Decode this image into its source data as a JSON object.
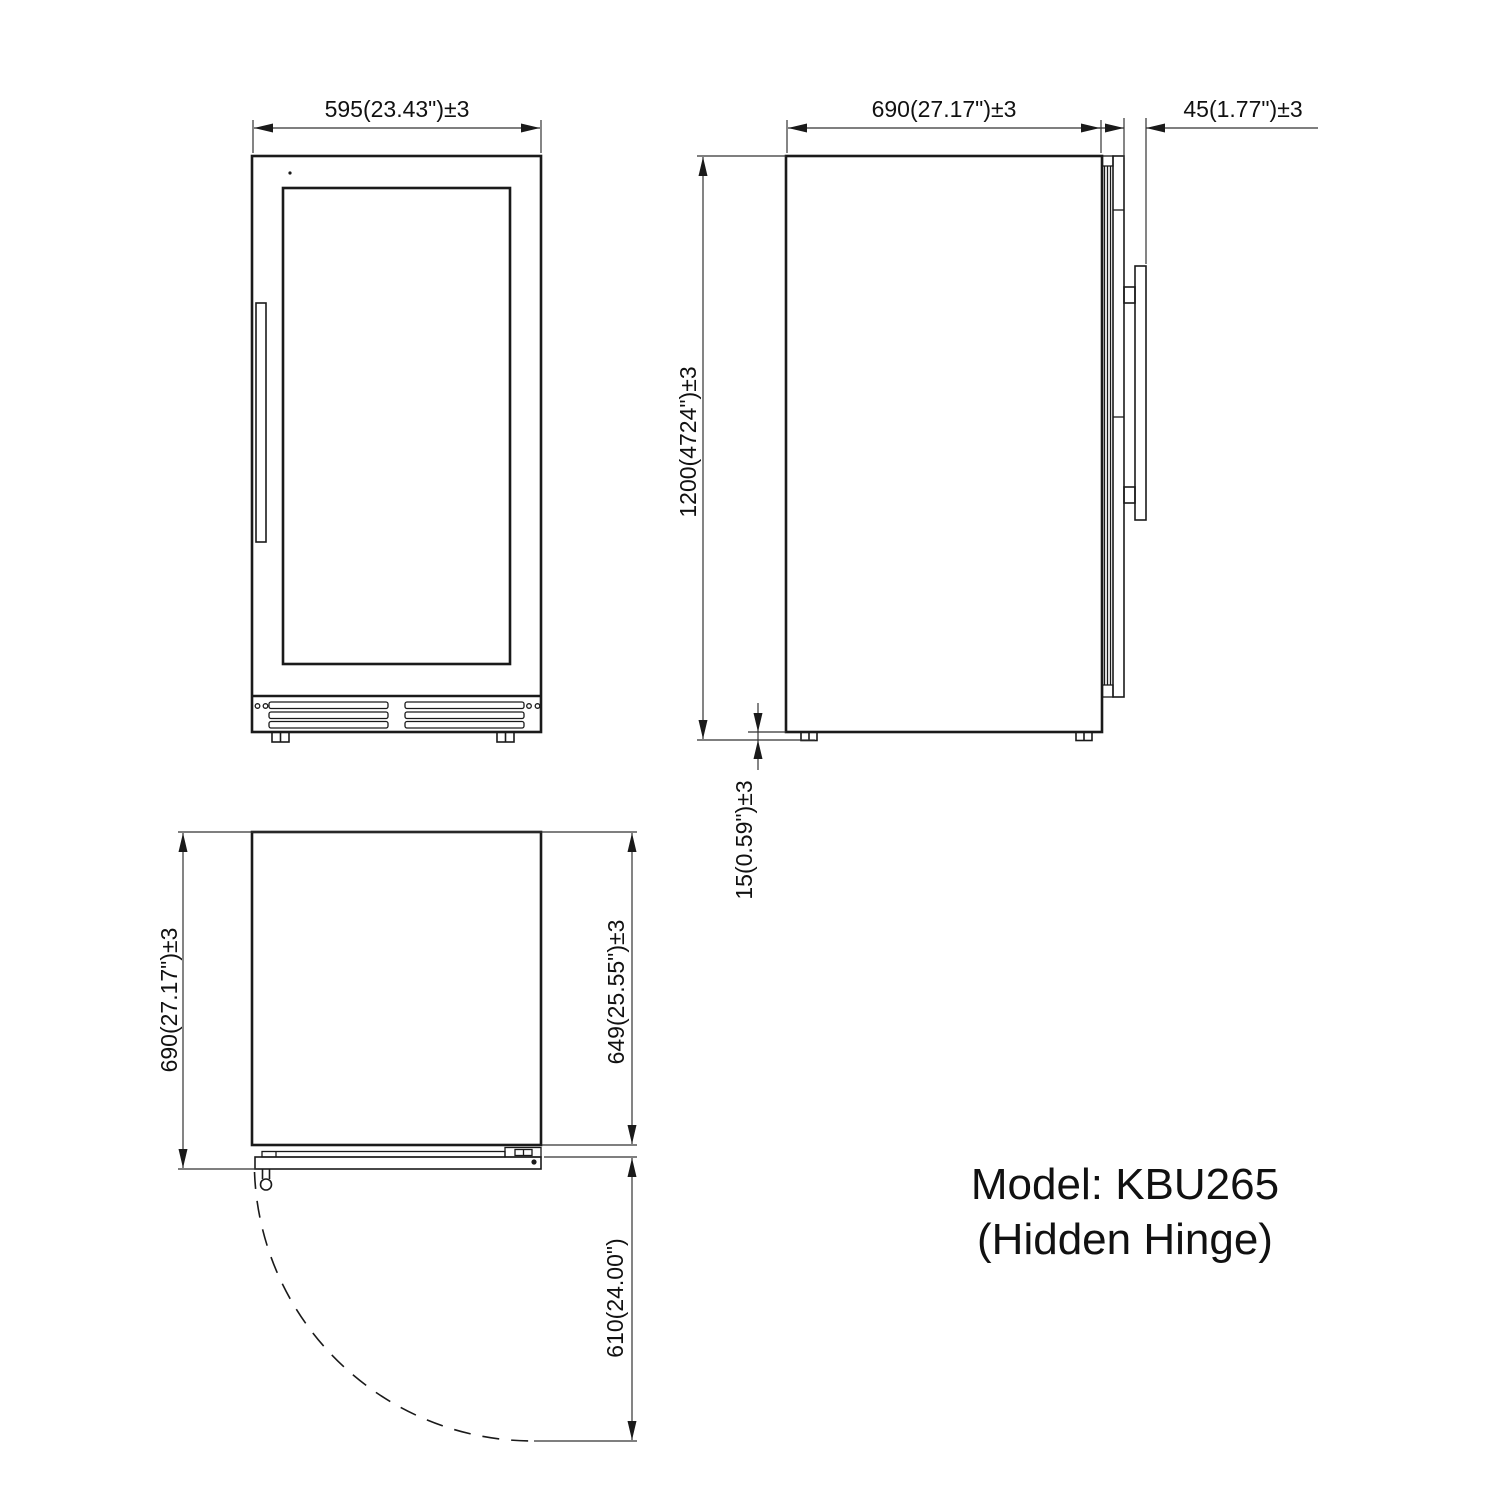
{
  "drawing": {
    "type": "appliance-dimension-drawing",
    "views": [
      "front",
      "side",
      "top"
    ],
    "line_color": "#1a1a1a",
    "background_color": "#ffffff"
  },
  "dimensions": {
    "front_width": "595(23.43\")±3",
    "side_depth": "690(27.17\")±3",
    "side_door_handle_depth": "45(1.77\")±3",
    "side_height": "1200(4724\")±3",
    "side_foot_height": "15(0.59\")±3",
    "top_overall_depth": "690(27.17\")±3",
    "top_body_depth": "649(25.55\")±3",
    "top_door_swing": "610(24.00\")"
  },
  "annotation": {
    "model_line1": "Model: KBU265",
    "model_line2": "(Hidden Hinge)"
  }
}
